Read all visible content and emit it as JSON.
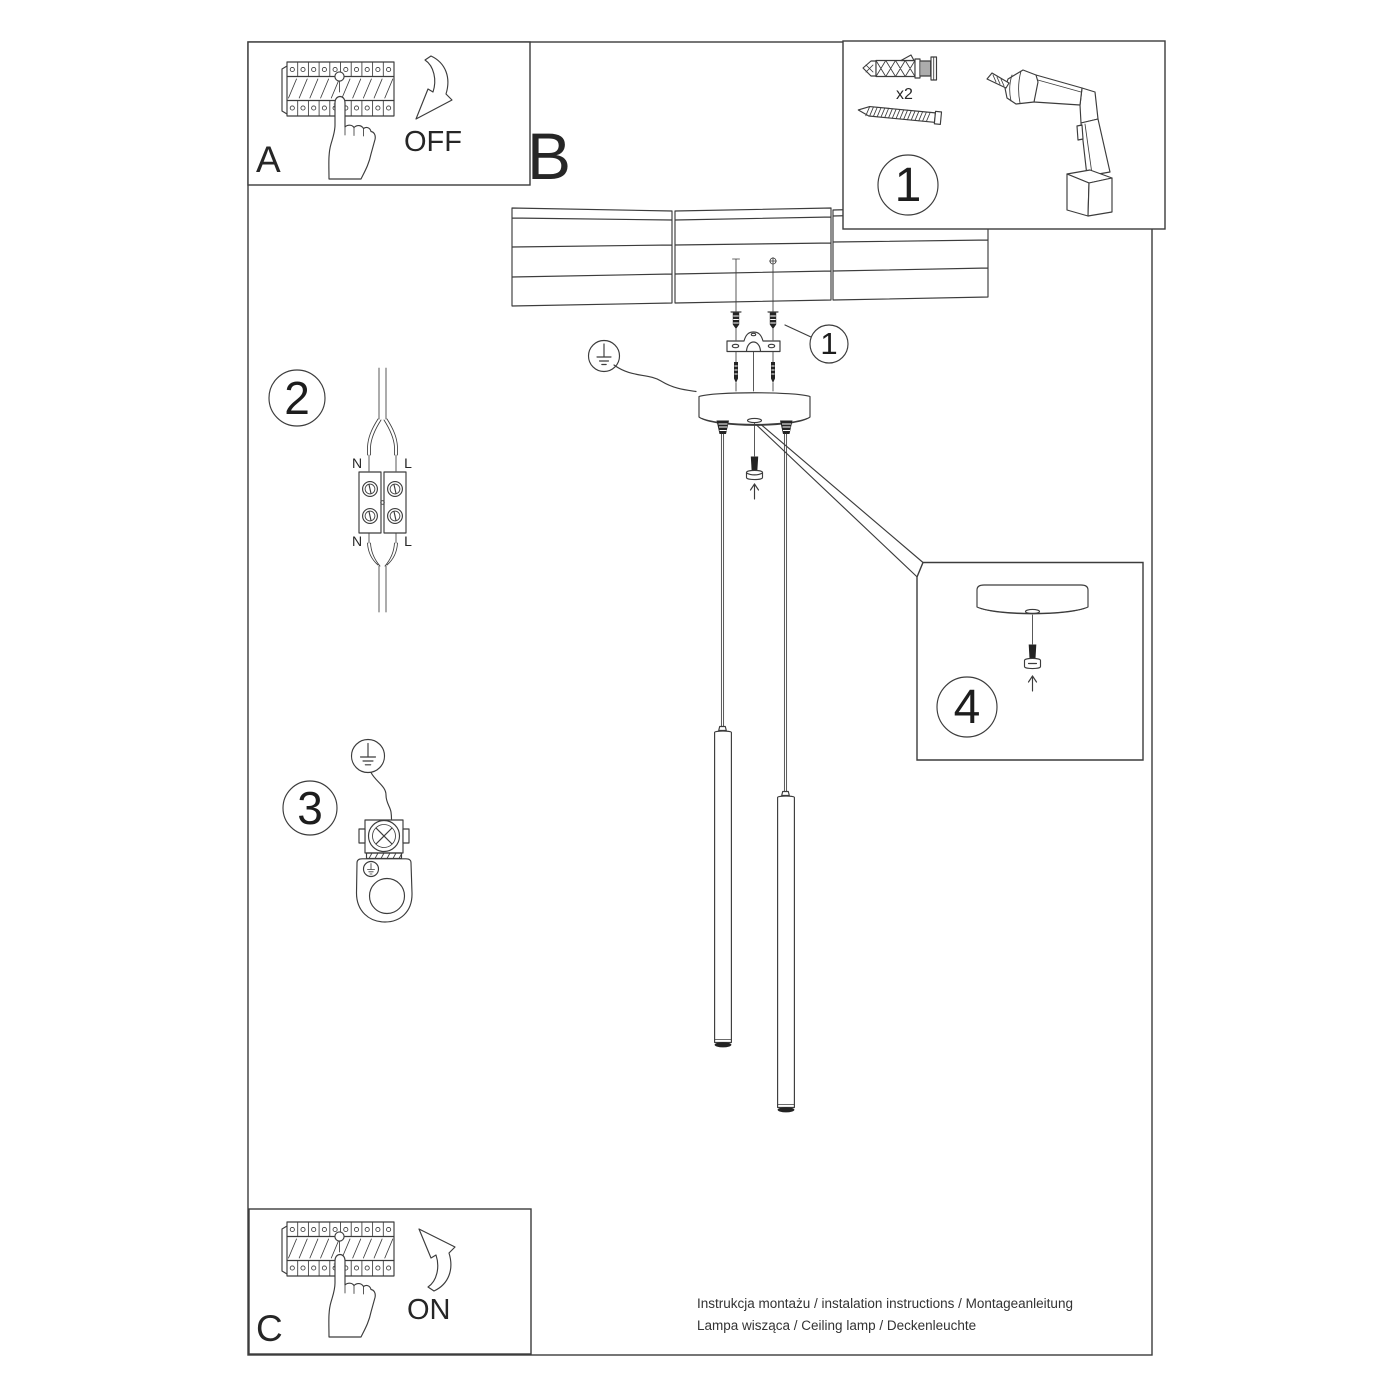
{
  "colors": {
    "line": "#3c3c3c",
    "dark_fill": "#232323",
    "text": "#262626",
    "background": "#ffffff"
  },
  "boxes": {
    "a": {
      "label": "A",
      "action": "OFF"
    },
    "b": {
      "label": "B"
    },
    "c": {
      "label": "C",
      "action": "ON"
    },
    "tools": {
      "badge": "1",
      "anchor_qty": "x2"
    },
    "step4": {
      "badge": "4"
    }
  },
  "callouts": {
    "mounting": "1",
    "wiring": "2",
    "grounding": "3"
  },
  "wiring_labels": {
    "top_n": "N",
    "top_l": "L",
    "bottom_n": "N",
    "bottom_l": "L"
  },
  "footer": {
    "line1": "Instrukcja montażu / instalation instructions / Montageanleitung",
    "line2": "Lampa wisząca / Ceiling lamp / Deckenleuchte"
  }
}
